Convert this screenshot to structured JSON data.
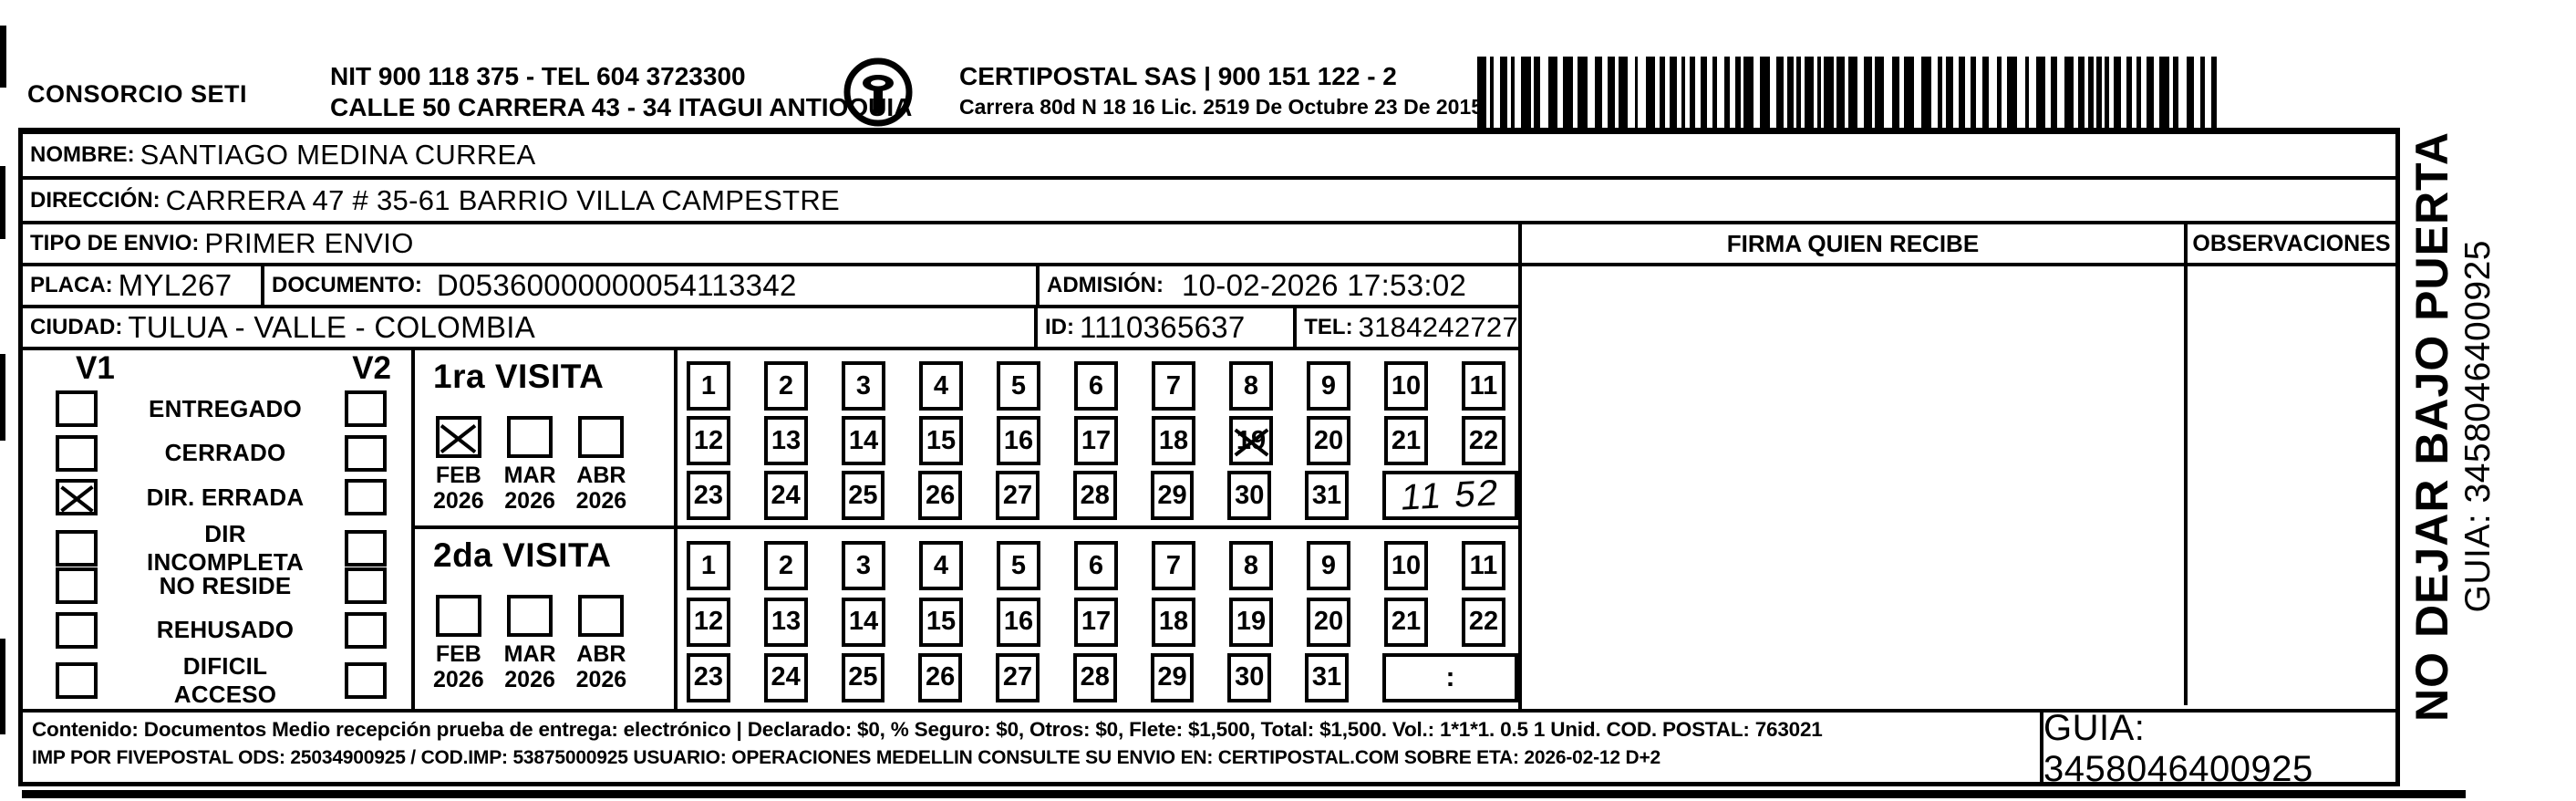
{
  "header": {
    "consorcio": "CONSORCIO SETI",
    "nit_line": "NIT 900 118 375 - TEL 604 3723300",
    "address_line": "CALLE 50 CARRERA 43 - 34 ITAGUI ANTIOQUIA",
    "logo_text": "CERTIPOSTAL",
    "company_line": "CERTIPOSTAL SAS | 900 151 122 - 2",
    "company_address": "Carrera 80d N 18 16  Lic. 2519 De Octubre 23 De 2015"
  },
  "recipient": {
    "nombre_label": "NOMBRE:",
    "nombre": "SANTIAGO MEDINA CURREA",
    "direccion_label": "DIRECCIÓN:",
    "direccion": "CARRERA 47 # 35-61 BARRIO VILLA CAMPESTRE",
    "tipo_label": "TIPO DE ENVIO:",
    "tipo": "PRIMER ENVIO",
    "placa_label": "PLACA:",
    "placa": "MYL267",
    "documento_label": "DOCUMENTO:",
    "documento": "D05360000000054113342",
    "admision_label": "ADMISIÓN:",
    "admision": "10-02-2026 17:53:02",
    "ciudad_label": "CIUDAD:",
    "ciudad": "TULUA - VALLE - COLOMBIA",
    "id_label": "ID:",
    "id_value": "1110365637",
    "tel_label": "TEL:",
    "tel": "3184242727"
  },
  "columns": {
    "firma": "FIRMA QUIEN RECIBE",
    "observaciones": "OBSERVACIONES"
  },
  "status": {
    "v1_label": "V1",
    "v2_label": "V2",
    "options": [
      {
        "label": "ENTREGADO",
        "v1": false,
        "v2": false
      },
      {
        "label": "CERRADO",
        "v1": false,
        "v2": false
      },
      {
        "label": "DIR. ERRADA",
        "v1": true,
        "v2": false
      },
      {
        "label": "DIR INCOMPLETA",
        "v1": false,
        "v2": false
      },
      {
        "label": "NO RESIDE",
        "v1": false,
        "v2": false
      },
      {
        "label": "REHUSADO",
        "v1": false,
        "v2": false
      },
      {
        "label": "DIFICIL ACCESO",
        "v1": false,
        "v2": false
      }
    ]
  },
  "calendar": {
    "days": [
      1,
      2,
      3,
      4,
      5,
      6,
      7,
      8,
      9,
      10,
      11,
      12,
      13,
      14,
      15,
      16,
      17,
      18,
      19,
      20,
      21,
      22,
      23,
      24,
      25,
      26,
      27,
      28,
      29,
      30,
      31
    ]
  },
  "visits": [
    {
      "title": "1ra VISITA",
      "months": [
        {
          "label": "FEB",
          "year": "2026",
          "checked": true
        },
        {
          "label": "MAR",
          "year": "2026",
          "checked": false
        },
        {
          "label": "ABR",
          "year": "2026",
          "checked": false
        }
      ],
      "crossed_days": [
        19
      ],
      "extra_text": "11 52",
      "extra_handwritten": true
    },
    {
      "title": "2da VISITA",
      "months": [
        {
          "label": "FEB",
          "year": "2026",
          "checked": false
        },
        {
          "label": "MAR",
          "year": "2026",
          "checked": false
        },
        {
          "label": "ABR",
          "year": "2026",
          "checked": false
        }
      ],
      "crossed_days": [],
      "extra_text": ":",
      "extra_handwritten": false
    }
  ],
  "side_note": {
    "line1": "NO DEJAR BAJO PUERTA",
    "line2": "GUIA: 3458046400925"
  },
  "footer": {
    "line1": "Contenido: Documentos Medio recepción prueba de entrega: electrónico | Declarado: $0, % Seguro: $0, Otros: $0, Flete: $1,500, Total: $1,500. Vol.: 1*1*1. 0.5  1 Unid. COD. POSTAL: 763021",
    "line2": "IMP POR FIVEPOSTAL ODS: 25034900925 / COD.IMP: 53875000925 USUARIO: OPERACIONES MEDELLIN CONSULTE SU ENVIO EN: CERTIPOSTAL.COM SOBRE ETA: 2026-02-12 D+2",
    "guia": "GUIA: 3458046400925"
  }
}
